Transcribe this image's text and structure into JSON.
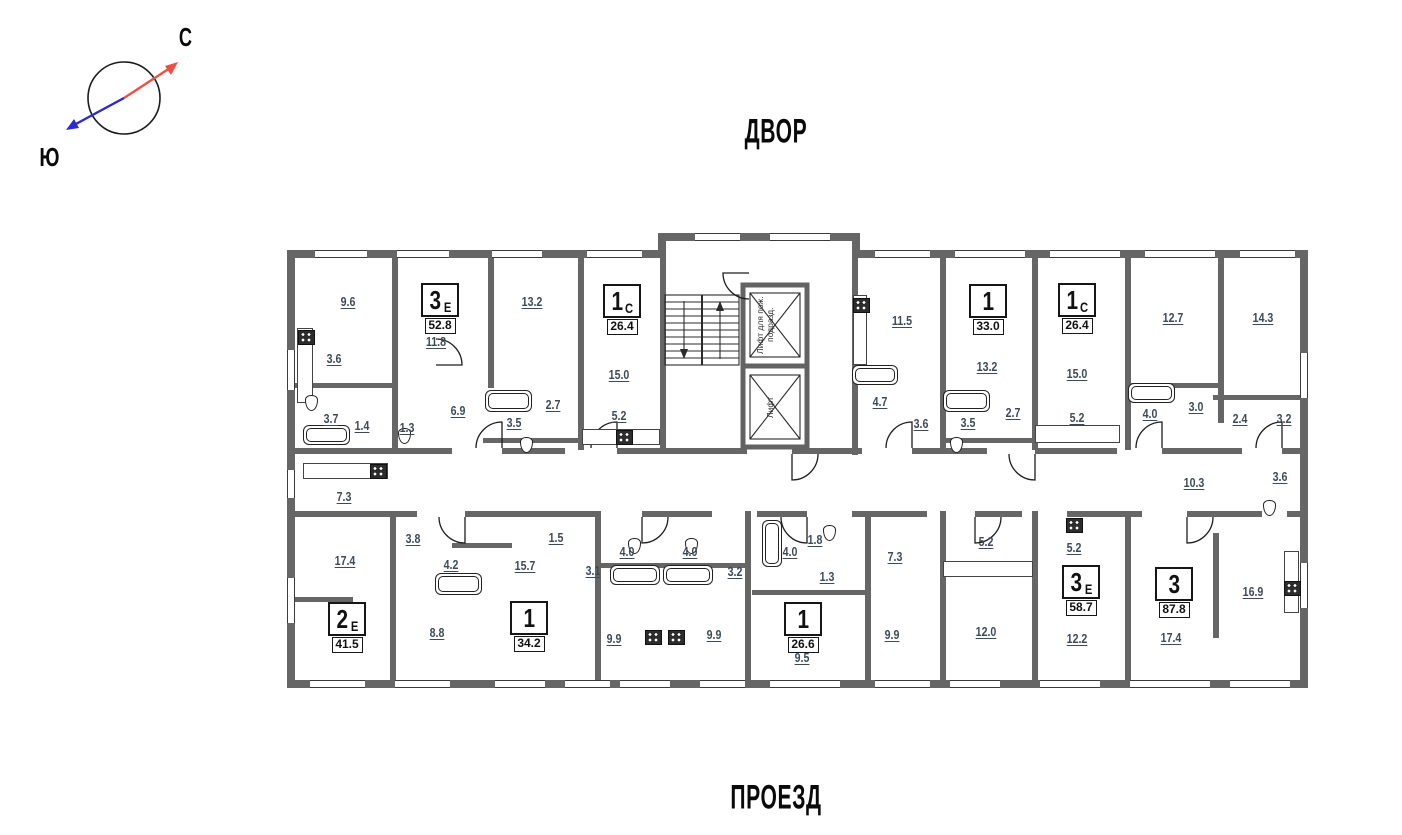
{
  "compass": {
    "north": "С",
    "south": "Ю"
  },
  "surroundings": {
    "top": "ДВОР",
    "bottom": "ПРОЕЗД"
  },
  "core": {
    "fire_elevator": "Лифт для пож. подразд.",
    "elevator": "Лифт"
  },
  "colors": {
    "wall": "#666666",
    "room_label": "#3d4b57",
    "north_arrow": "#ee4f44",
    "south_arrow": "#2a2ad4"
  },
  "apartments": [
    {
      "type": "3",
      "suffix": "Е",
      "area": "52.8",
      "x": 134,
      "y": 50
    },
    {
      "type": "1",
      "suffix": "С",
      "area": "26.4",
      "x": 316,
      "y": 51
    },
    {
      "type": "1",
      "suffix": "",
      "area": "33.0",
      "x": 682,
      "y": 51
    },
    {
      "type": "1",
      "suffix": "С",
      "area": "26.4",
      "x": 771,
      "y": 50
    },
    {
      "type": "2",
      "suffix": "Е",
      "area": "41.5",
      "x": 41,
      "y": 369
    },
    {
      "type": "1",
      "suffix": "",
      "area": "34.2",
      "x": 223,
      "y": 368
    },
    {
      "type": "1",
      "suffix": "",
      "area": "26.6",
      "x": 497,
      "y": 369
    },
    {
      "type": "3",
      "suffix": "Е",
      "area": "58.7",
      "x": 775,
      "y": 332
    },
    {
      "type": "3",
      "suffix": "",
      "area": "87.8",
      "x": 868,
      "y": 334
    }
  ],
  "rooms": [
    {
      "area": "9.6",
      "x": 61,
      "y": 69
    },
    {
      "area": "13.2",
      "x": 245,
      "y": 69
    },
    {
      "area": "11.8",
      "x": 149,
      "y": 109
    },
    {
      "area": "3.6",
      "x": 47,
      "y": 126
    },
    {
      "area": "3.7",
      "x": 44,
      "y": 186
    },
    {
      "area": "1.4",
      "x": 75,
      "y": 193
    },
    {
      "area": "1.3",
      "x": 120,
      "y": 195
    },
    {
      "area": "6.9",
      "x": 171,
      "y": 178
    },
    {
      "area": "3.5",
      "x": 227,
      "y": 190
    },
    {
      "area": "2.7",
      "x": 266,
      "y": 172
    },
    {
      "area": "15.0",
      "x": 332,
      "y": 142
    },
    {
      "area": "5.2",
      "x": 332,
      "y": 183
    },
    {
      "area": "11.5",
      "x": 615,
      "y": 88
    },
    {
      "area": "13.2",
      "x": 700,
      "y": 134
    },
    {
      "area": "4.7",
      "x": 593,
      "y": 169
    },
    {
      "area": "3.6",
      "x": 634,
      "y": 191
    },
    {
      "area": "3.5",
      "x": 681,
      "y": 190
    },
    {
      "area": "2.7",
      "x": 726,
      "y": 180
    },
    {
      "area": "15.0",
      "x": 790,
      "y": 141
    },
    {
      "area": "5.2",
      "x": 790,
      "y": 185
    },
    {
      "area": "4.0",
      "x": 863,
      "y": 181
    },
    {
      "area": "12.7",
      "x": 886,
      "y": 85
    },
    {
      "area": "14.3",
      "x": 976,
      "y": 85
    },
    {
      "area": "3.0",
      "x": 909,
      "y": 174
    },
    {
      "area": "2.4",
      "x": 953,
      "y": 186
    },
    {
      "area": "3.2",
      "x": 997,
      "y": 186
    },
    {
      "area": "3.6",
      "x": 993,
      "y": 244
    },
    {
      "area": "10.3",
      "x": 907,
      "y": 250
    },
    {
      "area": "7.3",
      "x": 57,
      "y": 264
    },
    {
      "area": "17.4",
      "x": 58,
      "y": 328
    },
    {
      "area": "3.8",
      "x": 126,
      "y": 306
    },
    {
      "area": "4.2",
      "x": 164,
      "y": 332
    },
    {
      "area": "8.8",
      "x": 150,
      "y": 400
    },
    {
      "area": "1.5",
      "x": 269,
      "y": 305
    },
    {
      "area": "15.7",
      "x": 238,
      "y": 333
    },
    {
      "area": "3.1",
      "x": 306,
      "y": 338
    },
    {
      "area": "4.0",
      "x": 340,
      "y": 319
    },
    {
      "area": "4.0",
      "x": 403,
      "y": 319
    },
    {
      "area": "3.2",
      "x": 448,
      "y": 339
    },
    {
      "area": "9.9",
      "x": 327,
      "y": 406
    },
    {
      "area": "9.9",
      "x": 427,
      "y": 402
    },
    {
      "area": "4.0",
      "x": 503,
      "y": 319
    },
    {
      "area": "1.8",
      "x": 528,
      "y": 307
    },
    {
      "area": "1.3",
      "x": 540,
      "y": 344
    },
    {
      "area": "9.5",
      "x": 515,
      "y": 425
    },
    {
      "area": "7.3",
      "x": 608,
      "y": 324
    },
    {
      "area": "9.9",
      "x": 605,
      "y": 402
    },
    {
      "area": "5.2",
      "x": 699,
      "y": 309
    },
    {
      "area": "12.0",
      "x": 699,
      "y": 399
    },
    {
      "area": "5.2",
      "x": 787,
      "y": 315
    },
    {
      "area": "12.2",
      "x": 790,
      "y": 406
    },
    {
      "area": "16.9",
      "x": 966,
      "y": 359
    },
    {
      "area": "17.4",
      "x": 884,
      "y": 405
    }
  ]
}
